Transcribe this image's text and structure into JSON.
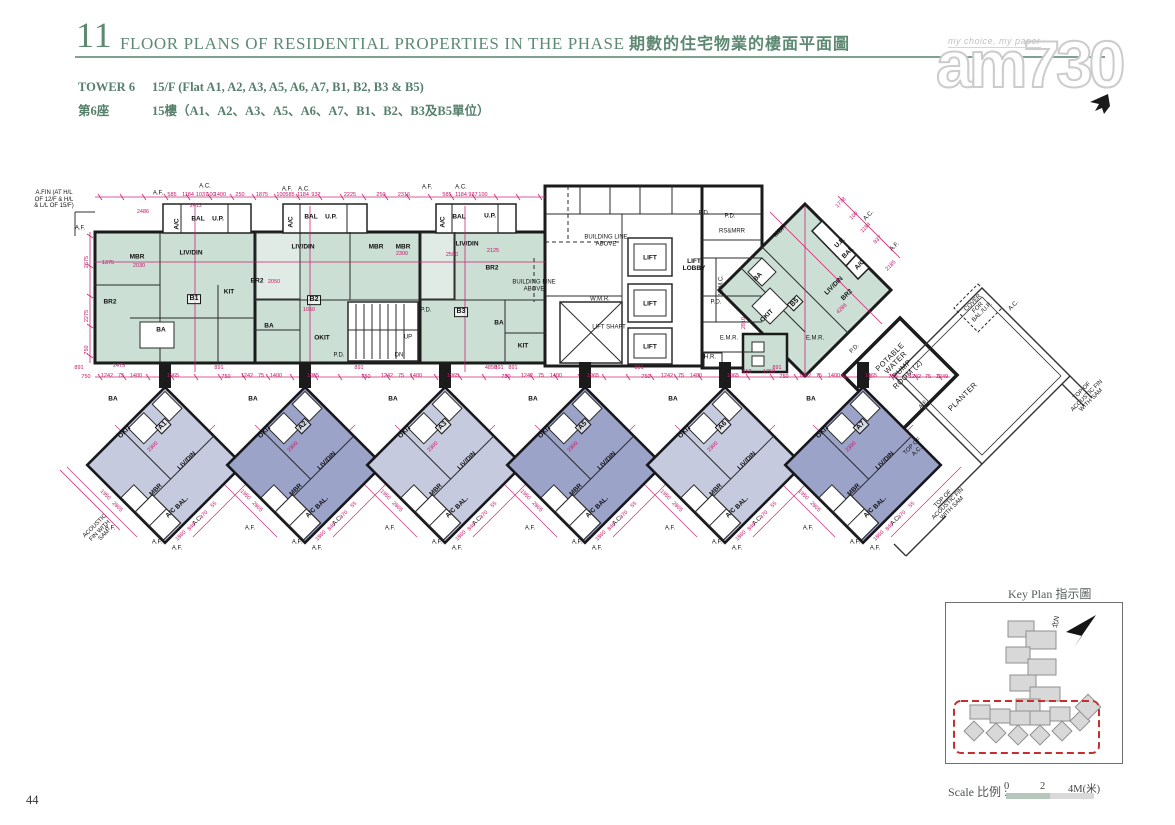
{
  "header": {
    "section_no": "11",
    "title_en": "FLOOR PLANS OF RESIDENTIAL PROPERTIES IN THE PHASE",
    "title_zh": "期數的住宅物業的樓面平面圖"
  },
  "subheader": {
    "tower_en": "TOWER 6",
    "tower_zh": "第6座",
    "floor_en": "15/F (Flat A1, A2, A3, A5, A6, A7, B1, B2, B3 & B5)",
    "floor_zh": "15樓（A1、A2、A3、A5、A6、A7、B1、B2、B3及B5單位）"
  },
  "watermark": {
    "tagline": "my choice, my paper",
    "logo": "am730"
  },
  "key_plan": {
    "title": "Key Plan 指示圖",
    "north_label": "北N"
  },
  "scale_bar": {
    "label": "Scale 比例 :",
    "tick0": "0",
    "tick1": "2",
    "tick2": "4M(米)"
  },
  "page": {
    "number": "44"
  },
  "colors": {
    "accent_green": "#5d8973",
    "dim_magenta": "#c41668",
    "teal_fill": "#cbdfd5",
    "unit_light": "#c6cade",
    "unit_dark": "#9ba3c9",
    "keyplan_red": "#c43030",
    "wall": "#1b1b1b"
  },
  "plan": {
    "labels": [
      {
        "t": "A.FIN (AT H/L\nOF 12/F & H/L\n& L/L OF 15/F)",
        "x": 54,
        "y": 200,
        "c": "anno"
      },
      {
        "t": "A.F.",
        "x": 80,
        "y": 229,
        "c": "anno"
      },
      {
        "t": "A.F.",
        "x": 158,
        "y": 194,
        "c": "anno"
      },
      {
        "t": "A.C.",
        "x": 205,
        "y": 187,
        "c": "anno"
      },
      {
        "t": "A.F.",
        "x": 287,
        "y": 190,
        "c": "anno"
      },
      {
        "t": "A.C.",
        "x": 304,
        "y": 190,
        "c": "anno"
      },
      {
        "t": "A.F.",
        "x": 427,
        "y": 188,
        "c": "anno"
      },
      {
        "t": "A.C.",
        "x": 461,
        "y": 188,
        "c": "anno"
      },
      {
        "t": "A.C.",
        "x": 869,
        "y": 216,
        "r": -45,
        "c": "anno"
      },
      {
        "t": "A.F.",
        "x": 895,
        "y": 247,
        "r": -45,
        "c": "anno"
      },
      {
        "t": "MBR",
        "x": 137,
        "y": 257,
        "c": "room"
      },
      {
        "t": "LIV/DIN",
        "x": 191,
        "y": 253,
        "c": "room"
      },
      {
        "t": "BR2",
        "x": 110,
        "y": 302,
        "c": "room"
      },
      {
        "t": "BA",
        "x": 161,
        "y": 330,
        "c": "room"
      },
      {
        "t": "KIT",
        "x": 229,
        "y": 292,
        "c": "room"
      },
      {
        "t": "B1",
        "x": 194,
        "y": 299,
        "c": "unit"
      },
      {
        "t": "A/C",
        "x": 177,
        "y": 224,
        "r": -90,
        "c": "room"
      },
      {
        "t": "BAL",
        "x": 198,
        "y": 219,
        "c": "room"
      },
      {
        "t": "U.P.",
        "x": 218,
        "y": 219,
        "c": "room"
      },
      {
        "t": "LIV/DIN",
        "x": 303,
        "y": 247,
        "c": "room"
      },
      {
        "t": "BR2",
        "x": 257,
        "y": 281,
        "c": "room"
      },
      {
        "t": "OKIT",
        "x": 322,
        "y": 338,
        "c": "room"
      },
      {
        "t": "BA",
        "x": 269,
        "y": 326,
        "c": "room"
      },
      {
        "t": "B2",
        "x": 314,
        "y": 300,
        "c": "unit"
      },
      {
        "t": "MBR",
        "x": 376,
        "y": 247,
        "c": "room"
      },
      {
        "t": "A/C",
        "x": 291,
        "y": 222,
        "r": -90,
        "c": "room"
      },
      {
        "t": "BAL",
        "x": 311,
        "y": 217,
        "c": "room"
      },
      {
        "t": "U.P.",
        "x": 331,
        "y": 217,
        "c": "room"
      },
      {
        "t": "MBR",
        "x": 403,
        "y": 247,
        "c": "room"
      },
      {
        "t": "LIV/DIN",
        "x": 467,
        "y": 244,
        "c": "room"
      },
      {
        "t": "BR2",
        "x": 492,
        "y": 268,
        "c": "room"
      },
      {
        "t": "B3",
        "x": 461,
        "y": 312,
        "c": "unit"
      },
      {
        "t": "KIT",
        "x": 523,
        "y": 346,
        "c": "room"
      },
      {
        "t": "BA",
        "x": 499,
        "y": 323,
        "c": "room"
      },
      {
        "t": "A/C",
        "x": 443,
        "y": 222,
        "r": -90,
        "c": "room"
      },
      {
        "t": "BAL",
        "x": 459,
        "y": 217,
        "c": "room"
      },
      {
        "t": "U.P.",
        "x": 490,
        "y": 216,
        "c": "room"
      },
      {
        "t": "UP",
        "x": 408,
        "y": 338,
        "c": "anno"
      },
      {
        "t": "DN",
        "x": 399,
        "y": 356,
        "c": "anno"
      },
      {
        "t": "P.D.",
        "x": 426,
        "y": 311,
        "c": "anno"
      },
      {
        "t": "P.D.",
        "x": 339,
        "y": 356,
        "c": "anno"
      },
      {
        "t": "BUILDING LINE\nABOVE",
        "x": 606,
        "y": 241,
        "c": "anno"
      },
      {
        "t": "BUILDING LINE\nABOVE",
        "x": 534,
        "y": 286,
        "c": "anno"
      },
      {
        "t": "W.M.R.",
        "x": 600,
        "y": 300,
        "c": "anno"
      },
      {
        "t": "LIFT SHAFT",
        "x": 609,
        "y": 328,
        "c": "anno"
      },
      {
        "t": "LIFT",
        "x": 650,
        "y": 258,
        "c": "room"
      },
      {
        "t": "LIFT",
        "x": 650,
        "y": 304,
        "c": "room"
      },
      {
        "t": "LIFT",
        "x": 650,
        "y": 347,
        "c": "room"
      },
      {
        "t": "LIFT\nLOBBY",
        "x": 694,
        "y": 265,
        "c": "room"
      },
      {
        "t": "P.D.",
        "x": 704,
        "y": 214,
        "c": "anno"
      },
      {
        "t": "P.D.",
        "x": 730,
        "y": 217,
        "c": "anno"
      },
      {
        "t": "RS&MRR",
        "x": 732,
        "y": 232,
        "c": "anno"
      },
      {
        "t": "W.M.C.",
        "x": 722,
        "y": 285,
        "r": -90,
        "c": "anno"
      },
      {
        "t": "P.D.",
        "x": 716,
        "y": 303,
        "c": "anno"
      },
      {
        "t": "E.M.R.",
        "x": 729,
        "y": 339,
        "c": "anno"
      },
      {
        "t": "E.M.R.",
        "x": 815,
        "y": 339,
        "c": "anno"
      },
      {
        "t": "H.R.",
        "x": 710,
        "y": 358,
        "c": "anno"
      },
      {
        "t": "MBR",
        "x": 780,
        "y": 231,
        "r": -45,
        "c": "room"
      },
      {
        "t": "BA",
        "x": 758,
        "y": 277,
        "r": -45,
        "c": "room"
      },
      {
        "t": "LIV/DIN",
        "x": 834,
        "y": 286,
        "r": -45,
        "c": "room"
      },
      {
        "t": "BR2",
        "x": 847,
        "y": 295,
        "r": -45,
        "c": "room"
      },
      {
        "t": "B5",
        "x": 795,
        "y": 303,
        "r": -45,
        "c": "unit"
      },
      {
        "t": "OKIT",
        "x": 767,
        "y": 316,
        "r": -45,
        "c": "room"
      },
      {
        "t": "BAL",
        "x": 848,
        "y": 253,
        "r": -45,
        "c": "room"
      },
      {
        "t": "U.P.",
        "x": 840,
        "y": 243,
        "r": -45,
        "c": "room"
      },
      {
        "t": "A/C",
        "x": 860,
        "y": 265,
        "r": -45,
        "c": "room"
      },
      {
        "t": "P.D.",
        "x": 855,
        "y": 349,
        "r": -45,
        "c": "anno"
      },
      {
        "t": "POTABLE\nWATER\nPUMP\nROOM (2)",
        "x": 899,
        "y": 366,
        "r": -45,
        "c": "anno-lg"
      },
      {
        "t": "PLANTER",
        "x": 963,
        "y": 397,
        "r": -45,
        "c": "anno-lg"
      },
      {
        "t": "COVER\nFOR\nBAL./U.P.",
        "x": 978,
        "y": 308,
        "r": -45,
        "c": "anno"
      },
      {
        "t": "A.C.",
        "x": 1014,
        "y": 306,
        "r": -45,
        "c": "anno"
      },
      {
        "t": "TOP OF\nACOUSTIC FIN\nWITH SAM",
        "x": 1087,
        "y": 396,
        "r": -45,
        "c": "anno"
      },
      {
        "t": "TOP OF\nA.C.",
        "x": 915,
        "y": 449,
        "r": -45,
        "c": "anno"
      },
      {
        "t": "TOP OF\nACOUSTIC FIN\nWITH SAM",
        "x": 948,
        "y": 504,
        "r": -45,
        "c": "anno"
      },
      {
        "t": "ACOUSTIC\nFIN WITH\nSAM",
        "x": 100,
        "y": 531,
        "r": -45,
        "c": "anno"
      },
      {
        "t": "C.L.",
        "x": 868,
        "y": 377,
        "c": "anno"
      },
      {
        "t": "A.F.",
        "x": 924,
        "y": 405,
        "r": -45,
        "c": "anno"
      },
      {
        "t": "2475",
        "x": 119,
        "y": 366,
        "c": "dim"
      },
      {
        "t": "4850",
        "x": 491,
        "y": 368,
        "c": "dim"
      },
      {
        "t": "891",
        "x": 513,
        "y": 368,
        "c": "dim"
      },
      {
        "t": "585",
        "x": 172,
        "y": 195,
        "c": "dim"
      },
      {
        "t": "1184",
        "x": 188,
        "y": 195,
        "c": "dim"
      },
      {
        "t": "1037",
        "x": 202,
        "y": 195,
        "c": "dim"
      },
      {
        "t": "100",
        "x": 211,
        "y": 195,
        "c": "dim"
      },
      {
        "t": "1400",
        "x": 220,
        "y": 195,
        "c": "dim"
      },
      {
        "t": "250",
        "x": 240,
        "y": 195,
        "c": "dim"
      },
      {
        "t": "1875",
        "x": 262,
        "y": 195,
        "c": "dim"
      },
      {
        "t": "100",
        "x": 281,
        "y": 195,
        "c": "dim"
      },
      {
        "t": "585",
        "x": 290,
        "y": 195,
        "c": "dim"
      },
      {
        "t": "1184",
        "x": 303,
        "y": 195,
        "c": "dim"
      },
      {
        "t": "937",
        "x": 316,
        "y": 195,
        "c": "dim"
      },
      {
        "t": "2225",
        "x": 350,
        "y": 195,
        "c": "dim"
      },
      {
        "t": "250",
        "x": 381,
        "y": 195,
        "c": "dim"
      },
      {
        "t": "2316",
        "x": 404,
        "y": 195,
        "c": "dim"
      },
      {
        "t": "585",
        "x": 447,
        "y": 195,
        "c": "dim"
      },
      {
        "t": "1184",
        "x": 461,
        "y": 195,
        "c": "dim"
      },
      {
        "t": "937",
        "x": 473,
        "y": 195,
        "c": "dim"
      },
      {
        "t": "100",
        "x": 483,
        "y": 195,
        "c": "dim"
      },
      {
        "t": "2486",
        "x": 143,
        "y": 212,
        "c": "dim"
      },
      {
        "t": "2412",
        "x": 196,
        "y": 206,
        "c": "dim"
      },
      {
        "t": "2675",
        "x": 87,
        "y": 262,
        "r": -90,
        "c": "dim"
      },
      {
        "t": "2275",
        "x": 87,
        "y": 316,
        "r": -90,
        "c": "dim"
      },
      {
        "t": "750",
        "x": 87,
        "y": 350,
        "r": -90,
        "c": "dim"
      },
      {
        "t": "1375",
        "x": 108,
        "y": 263,
        "c": "dim"
      },
      {
        "t": "2030",
        "x": 139,
        "y": 266,
        "c": "dim"
      },
      {
        "t": "2050",
        "x": 274,
        "y": 282,
        "c": "dim"
      },
      {
        "t": "1050",
        "x": 309,
        "y": 310,
        "c": "dim"
      },
      {
        "t": "2300",
        "x": 402,
        "y": 254,
        "c": "dim"
      },
      {
        "t": "2500",
        "x": 452,
        "y": 255,
        "c": "dim"
      },
      {
        "t": "2125",
        "x": 493,
        "y": 251,
        "c": "dim"
      },
      {
        "t": "1778",
        "x": 841,
        "y": 203,
        "r": -45,
        "c": "dim"
      },
      {
        "t": "100",
        "x": 854,
        "y": 216,
        "r": -45,
        "c": "dim"
      },
      {
        "t": "1184",
        "x": 866,
        "y": 228,
        "r": -45,
        "c": "dim"
      },
      {
        "t": "937",
        "x": 878,
        "y": 240,
        "r": -45,
        "c": "dim"
      },
      {
        "t": "2185",
        "x": 891,
        "y": 266,
        "r": -45,
        "c": "dim"
      },
      {
        "t": "4286",
        "x": 842,
        "y": 309,
        "r": -45,
        "c": "dim"
      },
      {
        "t": "2810",
        "x": 744,
        "y": 323,
        "r": -90,
        "c": "dim"
      },
      {
        "t": "650",
        "x": 747,
        "y": 372,
        "c": "dim"
      },
      {
        "t": "1750",
        "x": 769,
        "y": 372,
        "c": "dim"
      },
      {
        "t": "750",
        "x": 893,
        "y": 377,
        "c": "dim"
      },
      {
        "t": "1242",
        "x": 915,
        "y": 377,
        "c": "dim"
      },
      {
        "t": "75",
        "x": 928,
        "y": 377,
        "c": "dim"
      },
      {
        "t": "1249",
        "x": 942,
        "y": 377,
        "c": "dim"
      }
    ],
    "lower_units": [
      {
        "id": "A1",
        "cx": 165,
        "shade": "light"
      },
      {
        "id": "A2",
        "cx": 305,
        "shade": "dark"
      },
      {
        "id": "A3",
        "cx": 445,
        "shade": "light"
      },
      {
        "id": "A5",
        "cx": 585,
        "shade": "dark"
      },
      {
        "id": "A6",
        "cx": 725,
        "shade": "light"
      },
      {
        "id": "A7",
        "cx": 863,
        "shade": "dark"
      }
    ],
    "lower_unit_cy": 465,
    "lower_unit_room_template": [
      {
        "t": "BA",
        "dx": -52,
        "dy": -66,
        "r": 0,
        "c": "room"
      },
      {
        "t": "OKIT",
        "dx": -40,
        "dy": -33,
        "r": -45,
        "c": "room"
      },
      {
        "t": "$ID",
        "dx": -2,
        "dy": -39,
        "r": -45,
        "c": "unit"
      },
      {
        "t": "LIV/DIN",
        "dx": 22,
        "dy": -4,
        "r": -45,
        "c": "room"
      },
      {
        "t": "MBR",
        "dx": -9,
        "dy": 25,
        "r": -45,
        "c": "room"
      },
      {
        "t": "BAL.",
        "dx": 17,
        "dy": 38,
        "r": -45,
        "c": "room"
      },
      {
        "t": "A/C",
        "dx": 6,
        "dy": 48,
        "r": -45,
        "c": "room"
      },
      {
        "t": "A.C.",
        "dx": 33,
        "dy": 56,
        "r": -45,
        "c": "anno"
      },
      {
        "t": "A.F.",
        "dx": -8,
        "dy": 78,
        "r": 0,
        "c": "anno"
      },
      {
        "t": "A.F.",
        "dx": 12,
        "dy": 84,
        "r": 0,
        "c": "anno"
      },
      {
        "t": "A.F.",
        "dx": -55,
        "dy": 64,
        "r": 0,
        "c": "anno"
      }
    ],
    "lower_unit_dim_template": [
      {
        "t": "891",
        "dx": -86,
        "dy": -97,
        "r": 0
      },
      {
        "t": "750",
        "dx": -79,
        "dy": -88,
        "r": 0
      },
      {
        "t": "1242",
        "dx": -58,
        "dy": -89,
        "r": 0
      },
      {
        "t": "75",
        "dx": -44,
        "dy": -89,
        "r": 0
      },
      {
        "t": "1400",
        "dx": -29,
        "dy": -89,
        "r": 0
      },
      {
        "t": "1965",
        "dx": 8,
        "dy": -89,
        "r": 0
      },
      {
        "t": "2300",
        "dx": -12,
        "dy": -18,
        "r": -45
      },
      {
        "t": "2805",
        "dx": -48,
        "dy": 42,
        "r": 45
      },
      {
        "t": "1950",
        "dx": -60,
        "dy": 30,
        "r": 45
      },
      {
        "t": "840",
        "dx": 27,
        "dy": 62,
        "r": -45
      },
      {
        "t": "970",
        "dx": 39,
        "dy": 50,
        "r": -45
      },
      {
        "t": "55",
        "dx": 49,
        "dy": 40,
        "r": -45
      },
      {
        "t": "1860",
        "dx": 16,
        "dy": 71,
        "r": -45
      }
    ]
  }
}
